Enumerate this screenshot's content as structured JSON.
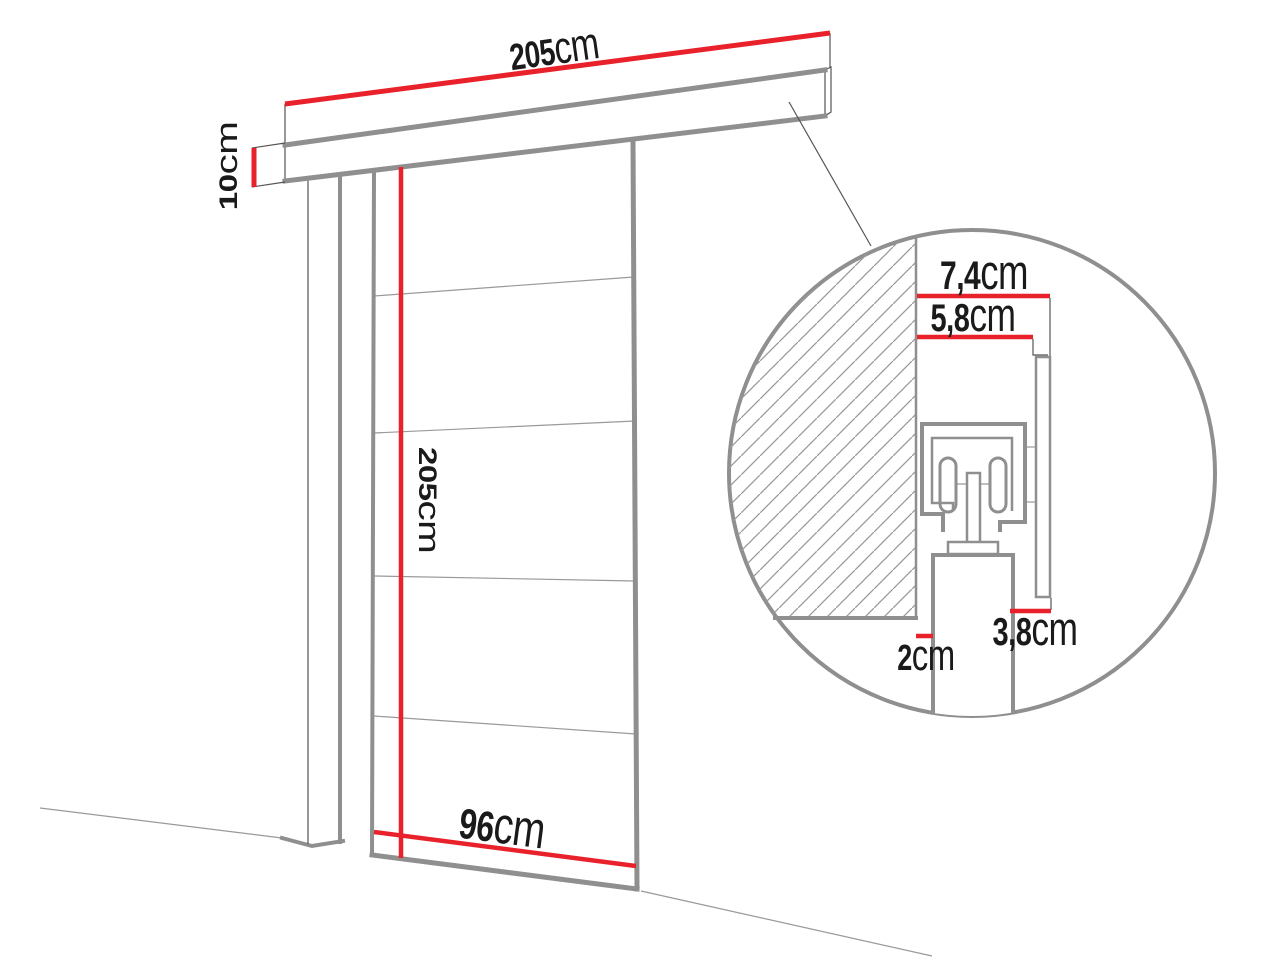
{
  "diagram": {
    "title": "sliding-door-dimension-diagram",
    "dimensions": {
      "track_length": {
        "value": "205",
        "unit": "cm"
      },
      "track_height": {
        "value": "10",
        "unit": "cm"
      },
      "door_height": {
        "value": "205",
        "unit": "cm"
      },
      "door_width": {
        "value": "96",
        "unit": "cm"
      },
      "detail_depth_total": {
        "value": "7,4",
        "unit": "cm"
      },
      "detail_depth_inner": {
        "value": "5,8",
        "unit": "cm"
      },
      "detail_wall_gap": {
        "value": "2",
        "unit": "cm"
      },
      "detail_fascia_width": {
        "value": "3,8",
        "unit": "cm"
      }
    },
    "colors": {
      "dimension_red": "#e8212a",
      "outline_gray": "#8f8f8f",
      "thin_line": "#555555",
      "text": "#1a1a1a"
    }
  }
}
